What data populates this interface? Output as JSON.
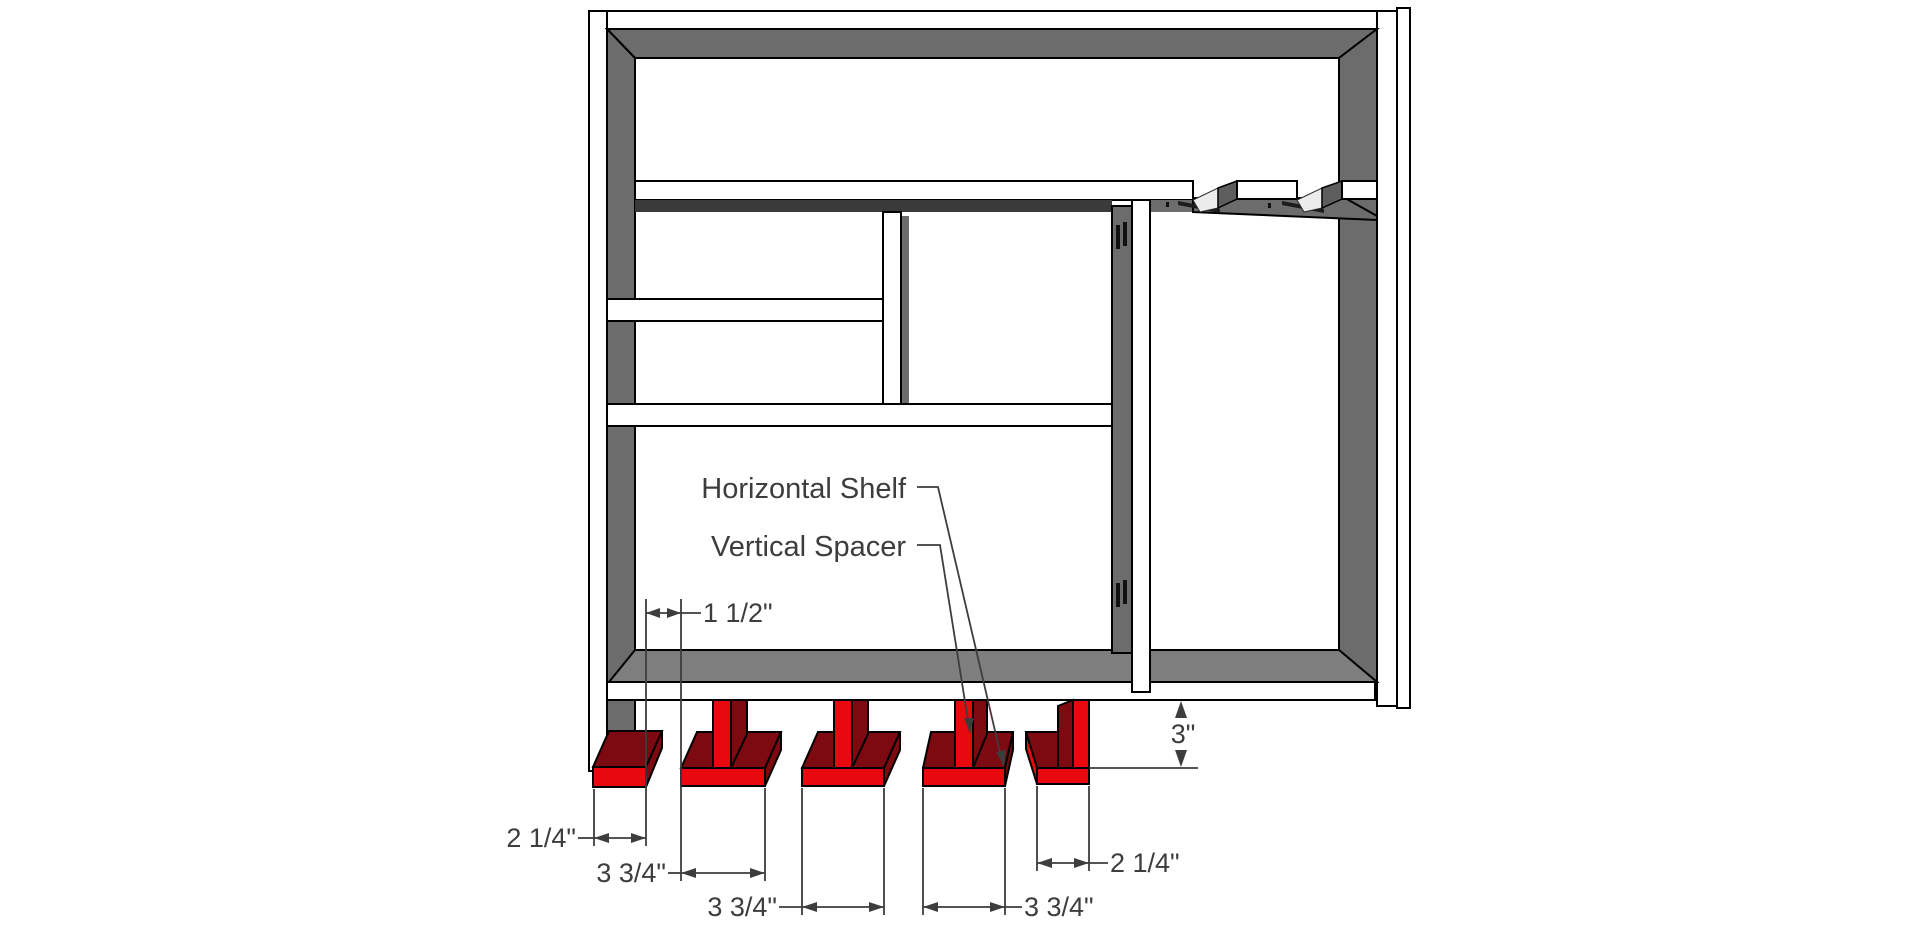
{
  "diagram": {
    "title": "Shelf unit construction diagram",
    "labels": {
      "horizontal_shelf": "Horizontal Shelf",
      "vertical_spacer": "Vertical Spacer"
    },
    "dimensions": {
      "spacer_gap": "1 1/2\"",
      "left_foot_width": "2 1/4\"",
      "foot_2_width": "3 3/4\"",
      "foot_3_width": "3 3/4\"",
      "foot_4_width": "3 3/4\"",
      "right_foot_width": "2 1/4\"",
      "foot_height": "3\""
    },
    "colors": {
      "foot_front": "#e8090f",
      "foot_shade": "#7c0a10",
      "frame_inner": "#6c6c6c",
      "rail_top": "#7e7e7e",
      "annotation": "#3d3d3d"
    }
  }
}
